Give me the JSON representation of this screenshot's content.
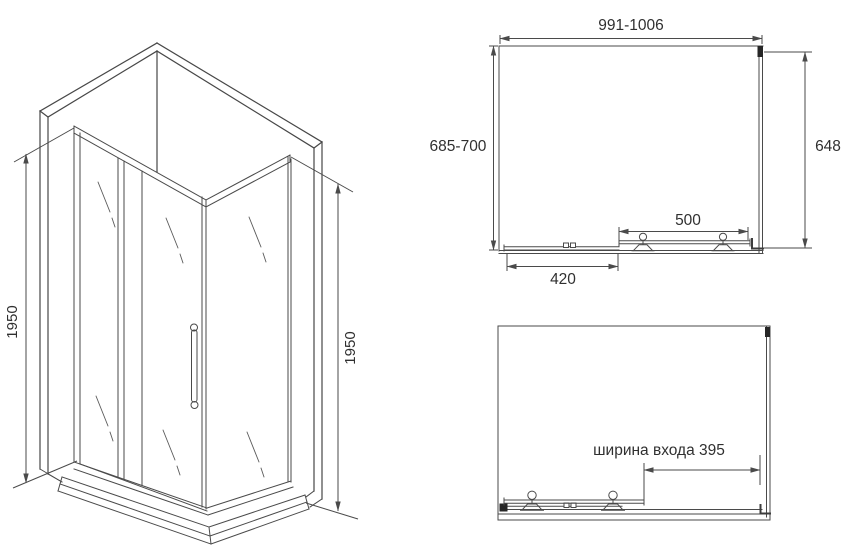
{
  "drawing": {
    "colors": {
      "line": "#4a4a4a",
      "text": "#303030"
    },
    "isometric_view": {
      "height_left_label": "1950",
      "height_right_label": "1950"
    },
    "top_view": {
      "width_label": "991-1006",
      "depth_left_label": "685-700",
      "depth_right_label": "648",
      "door_width_label": "500",
      "fixed_panel_label": "420"
    },
    "open_door_view": {
      "entrance_width_label": "ширина входа 395"
    }
  }
}
